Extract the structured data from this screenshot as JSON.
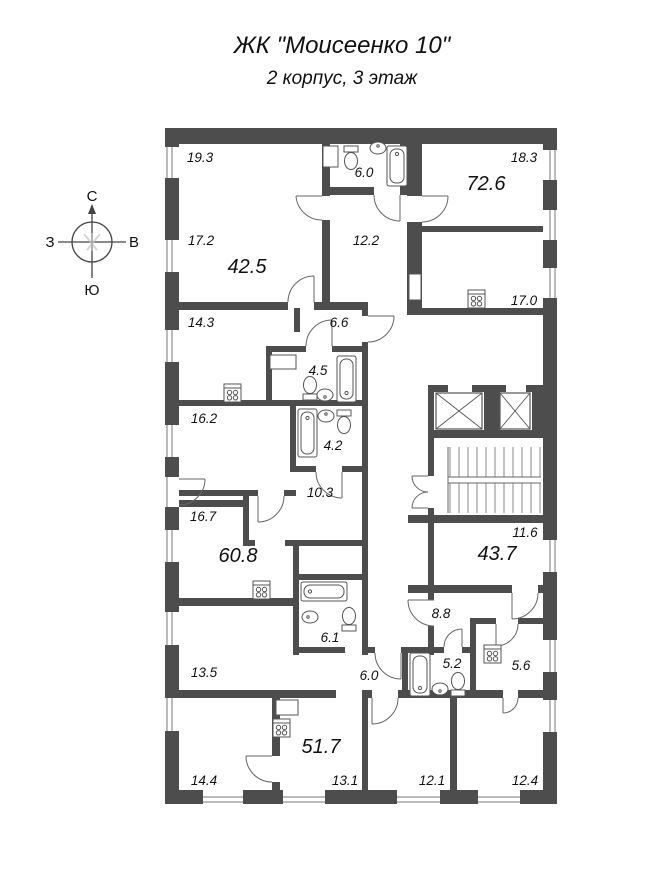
{
  "title": {
    "line1": "ЖК \"Моисеенко 10\"",
    "line2": "2 корпус, 3 этаж"
  },
  "compass": {
    "north": "С",
    "south": "Ю",
    "west": "З",
    "east": "В"
  },
  "floor_plan": {
    "rooms": [
      {
        "id": "room-19-3",
        "area": "19.3",
        "kind": "room"
      },
      {
        "id": "bath-6-0",
        "area": "6.0",
        "kind": "bathroom"
      },
      {
        "id": "room-18-3",
        "area": "18.3",
        "kind": "room"
      },
      {
        "id": "apt-72-6",
        "area": "72.6",
        "kind": "apartment-total"
      },
      {
        "id": "room-17-2",
        "area": "17.2",
        "kind": "room"
      },
      {
        "id": "apt-42-5",
        "area": "42.5",
        "kind": "apartment-total"
      },
      {
        "id": "hall-12-2",
        "area": "12.2",
        "kind": "hall"
      },
      {
        "id": "kitchen-17-0",
        "area": "17.0",
        "kind": "kitchen"
      },
      {
        "id": "kitchen-14-3",
        "area": "14.3",
        "kind": "kitchen"
      },
      {
        "id": "hall-6-6",
        "area": "6.6",
        "kind": "hall"
      },
      {
        "id": "bath-4-5",
        "area": "4.5",
        "kind": "bathroom"
      },
      {
        "id": "room-16-2",
        "area": "16.2",
        "kind": "room"
      },
      {
        "id": "bath-4-2",
        "area": "4.2",
        "kind": "bathroom"
      },
      {
        "id": "hall-10-3",
        "area": "10.3",
        "kind": "hall"
      },
      {
        "id": "room-16-7",
        "area": "16.7",
        "kind": "room"
      },
      {
        "id": "apt-60-8",
        "area": "60.8",
        "kind": "apartment-total"
      },
      {
        "id": "room-11-6",
        "area": "11.6",
        "kind": "room"
      },
      {
        "id": "apt-43-7",
        "area": "43.7",
        "kind": "apartment-total"
      },
      {
        "id": "room-13-5",
        "area": "13.5",
        "kind": "room"
      },
      {
        "id": "bath-6-1",
        "area": "6.1",
        "kind": "bathroom"
      },
      {
        "id": "hall-8-8",
        "area": "8.8",
        "kind": "hall"
      },
      {
        "id": "hall-6-0",
        "area": "6.0",
        "kind": "hall"
      },
      {
        "id": "bath-5-2",
        "area": "5.2",
        "kind": "bathroom"
      },
      {
        "id": "kitchen-5-6",
        "area": "5.6",
        "kind": "kitchen"
      },
      {
        "id": "apt-51-7",
        "area": "51.7",
        "kind": "apartment-total"
      },
      {
        "id": "room-14-4",
        "area": "14.4",
        "kind": "room"
      },
      {
        "id": "room-13-1",
        "area": "13.1",
        "kind": "room"
      },
      {
        "id": "room-12-1",
        "area": "12.1",
        "kind": "room"
      },
      {
        "id": "room-12-4",
        "area": "12.4",
        "kind": "room"
      }
    ],
    "colors": {
      "wall": "#4d4d4d",
      "line": "#555555",
      "background": "#ffffff"
    }
  }
}
